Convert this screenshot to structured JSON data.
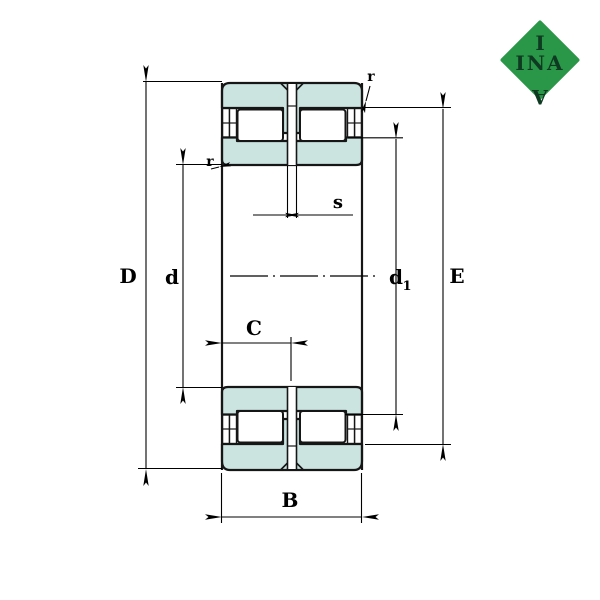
{
  "drawing": {
    "type": "bearing-cross-section",
    "labels": {
      "outer_diameter": "D",
      "bore_diameter": "d",
      "rib_diameter_base": "d",
      "rib_diameter_sub": "1",
      "raceway_diameter": "E",
      "width": "B",
      "inner_width": "C",
      "slot_width": "s",
      "chamfer_left": "r",
      "chamfer_right": "r"
    },
    "colors": {
      "ring_fill": "#cbe4e0",
      "outline": "#161616",
      "dimension_line": "#000000",
      "logo_green": "#2a9748",
      "logo_text": "#0e3a22"
    }
  },
  "logo": {
    "top": "I",
    "middle": "INA",
    "bottom": "A"
  }
}
